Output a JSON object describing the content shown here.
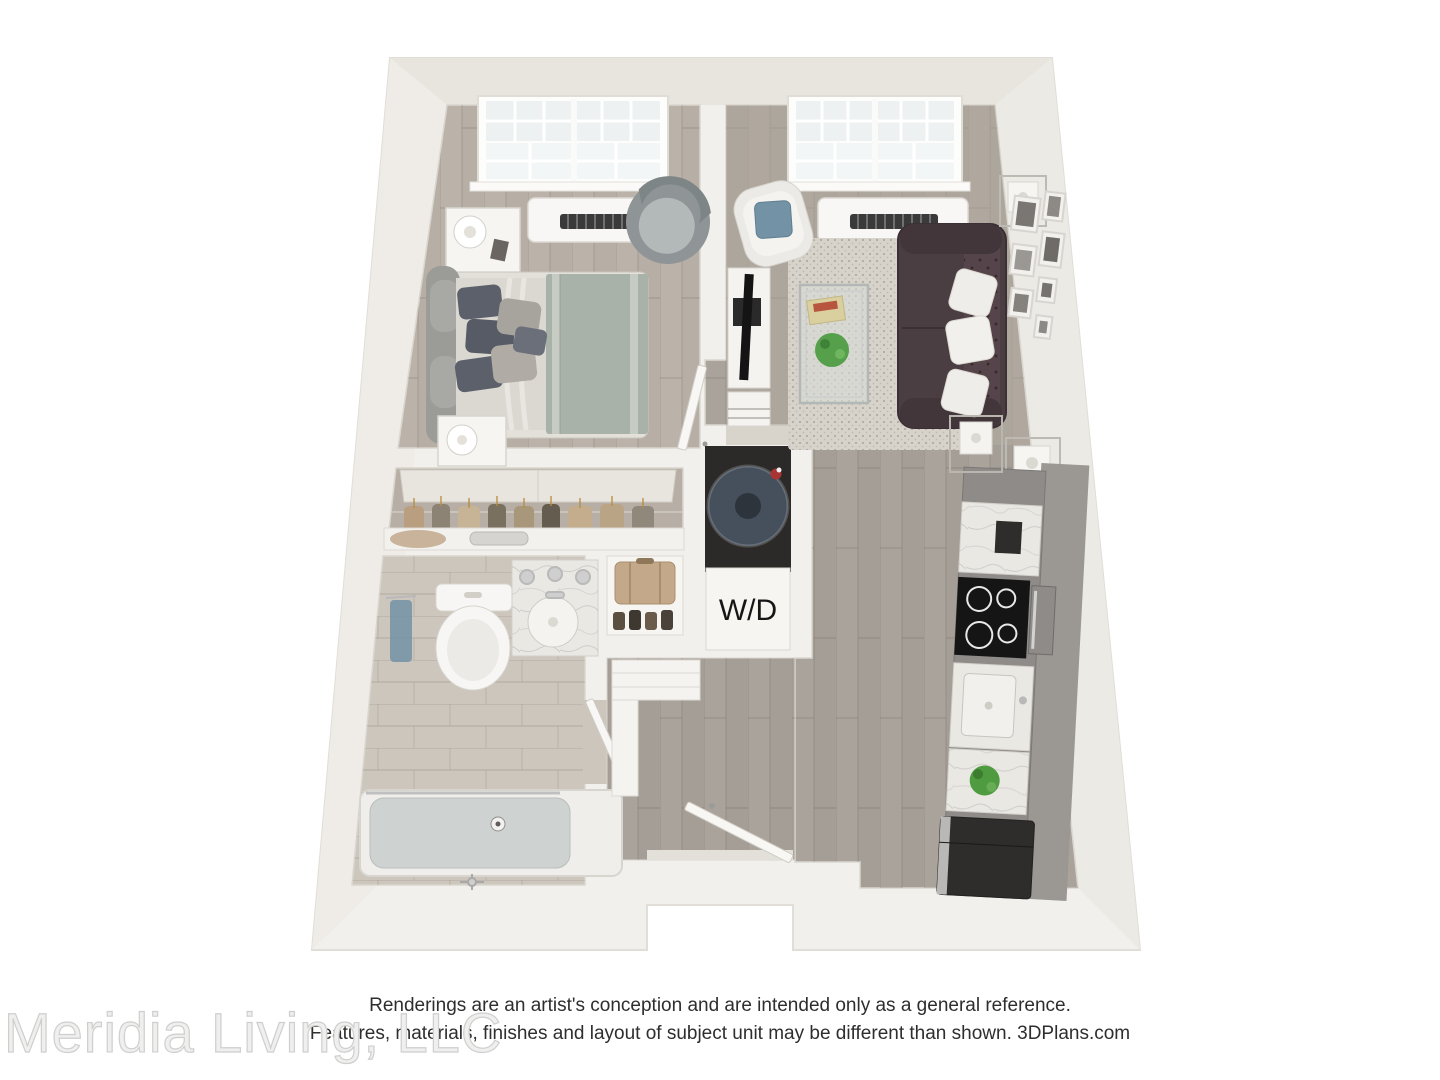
{
  "floorplan": {
    "wd_label": "W/D"
  },
  "footer": {
    "disclaimer_line1": "Renderings are an artist's conception and are intended only as a general reference.",
    "disclaimer_line2": "Features, materials, finishes and layout of subject unit may be different than shown. 3DPlans.com",
    "watermark": "Meridia Living, LLC"
  },
  "colors": {
    "wall": "#f2f0ec",
    "wall_shade": "#e8e5df",
    "wood_light": "#b7afa5",
    "wood_dark": "#a59e96",
    "tile": "#ccc6bd",
    "rug": "#d7d3cb",
    "sofa": "#4a3e43",
    "accent_blue": "#7392a6",
    "sage": "#a9b2a8",
    "cabinet": "#8e8b88",
    "marble": "#eae8e3",
    "appliance_dark": "#201e1d",
    "washer_navy": "#45505c",
    "tan": "#c3a88a"
  }
}
